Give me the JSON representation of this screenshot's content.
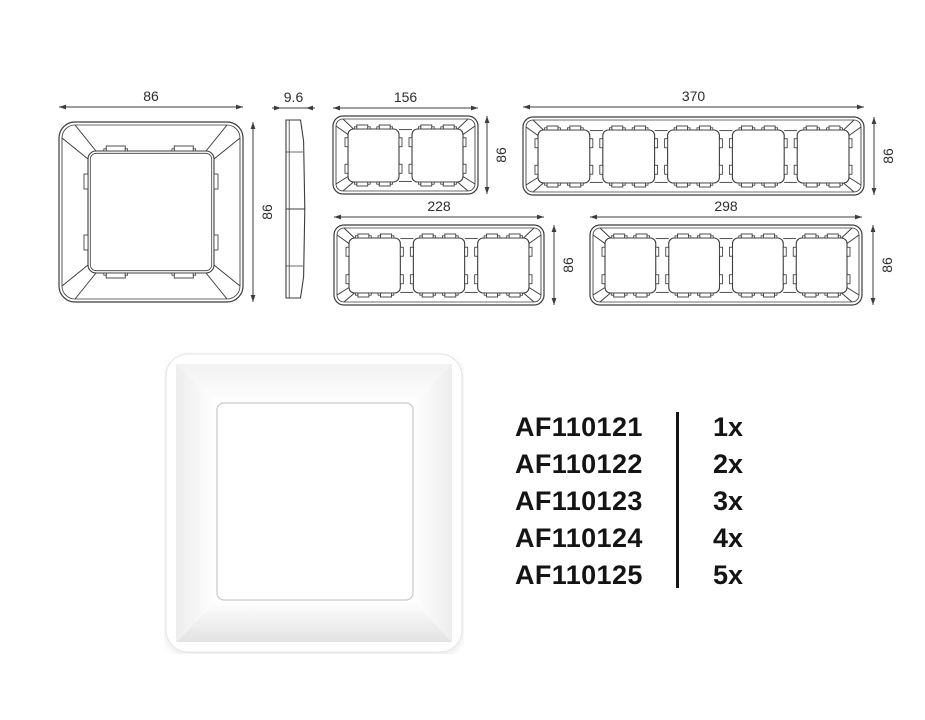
{
  "canvas": {
    "background": "#ffffff"
  },
  "drawing": {
    "line_color": "#3c3c3c",
    "label_color": "#2d2d2d",
    "front_views": [
      {
        "name": "frame-1-gang",
        "gangs": 1,
        "width_label": "86",
        "height_label": "86"
      },
      {
        "name": "frame-2-gang",
        "gangs": 2,
        "width_label": "156",
        "height_label": "86"
      },
      {
        "name": "frame-5-gang",
        "gangs": 5,
        "width_label": "370",
        "height_label": "86"
      },
      {
        "name": "frame-3-gang",
        "gangs": 3,
        "width_label": "228",
        "height_label": "86"
      },
      {
        "name": "frame-4-gang",
        "gangs": 4,
        "width_label": "298",
        "height_label": "86"
      }
    ],
    "side_view": {
      "name": "side-profile",
      "depth_label": "9.6"
    }
  },
  "render": {
    "name": "single-frame-product-render",
    "color": "#ffffff"
  },
  "parts_list": {
    "text_color": "#141414",
    "rows": [
      {
        "code": "AF110121",
        "qty": "1x"
      },
      {
        "code": "AF110122",
        "qty": "2x"
      },
      {
        "code": "AF110123",
        "qty": "3x"
      },
      {
        "code": "AF110124",
        "qty": "4x"
      },
      {
        "code": "AF110125",
        "qty": "5x"
      }
    ]
  }
}
